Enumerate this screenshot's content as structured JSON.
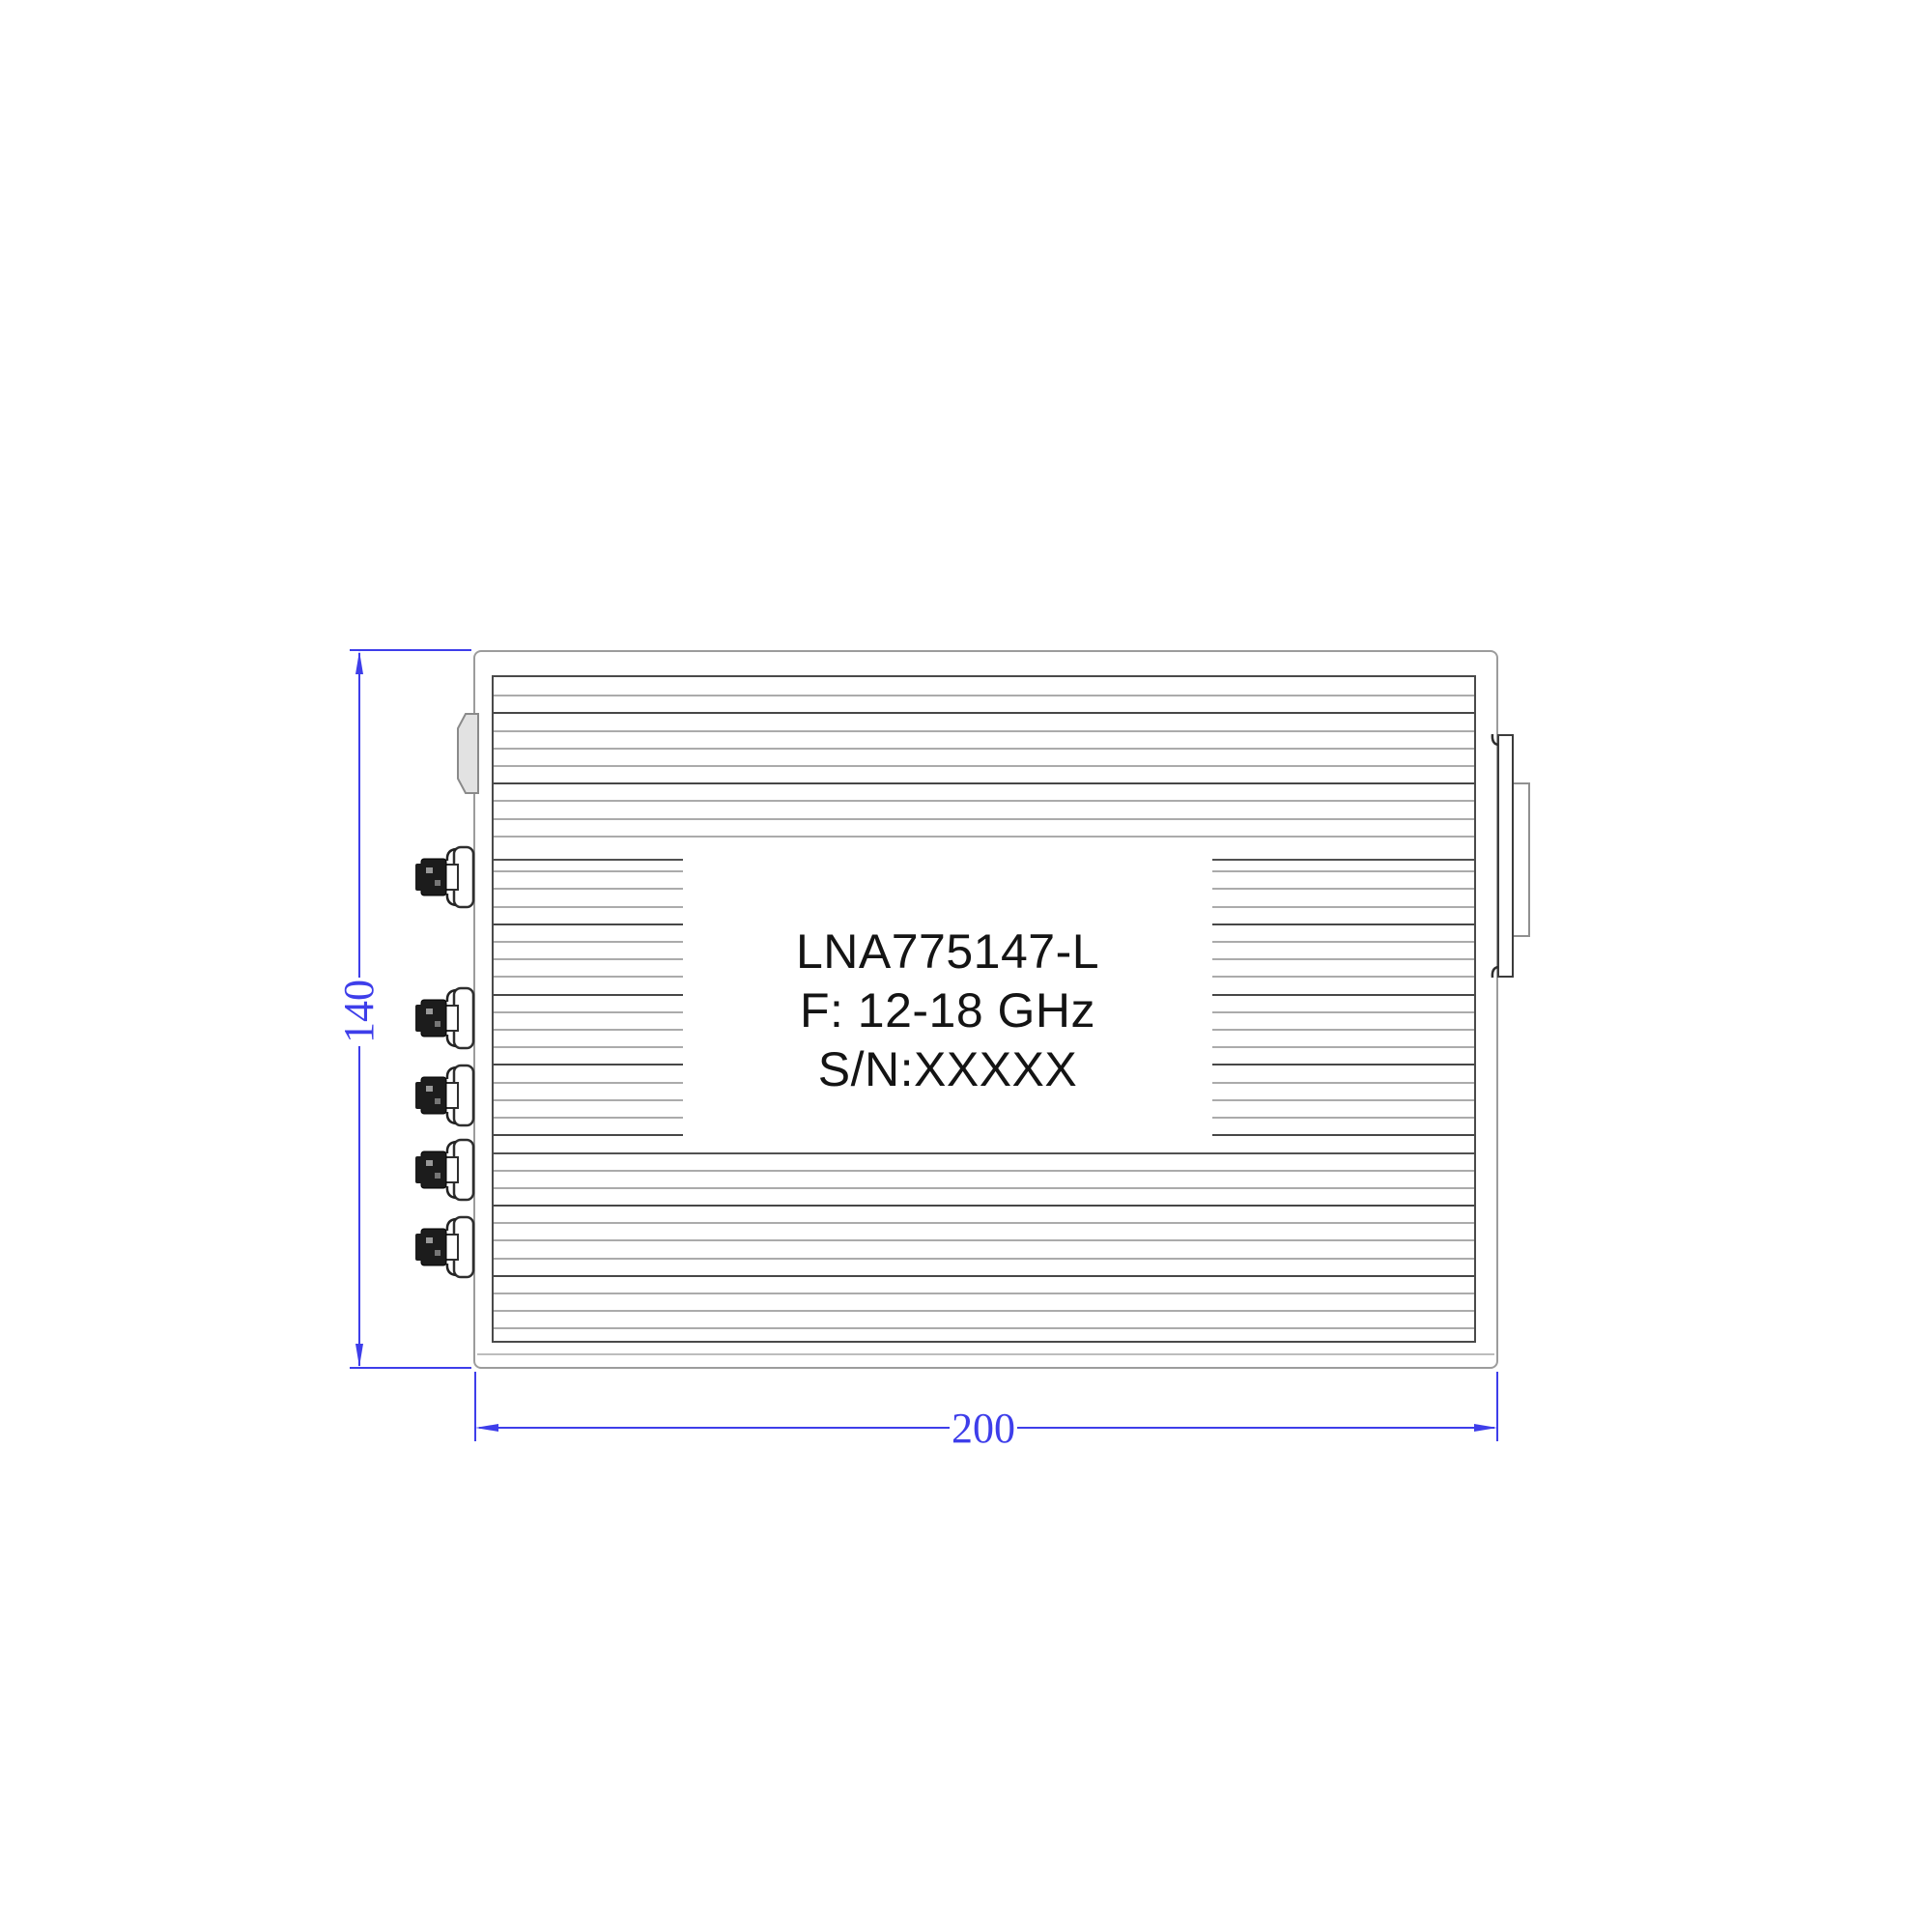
{
  "drawing": {
    "title": "LNA mechanical outline drawing",
    "label": {
      "model": "LNA775147-L",
      "frequency": "F: 12-18 GHz",
      "serial": "S/N:XXXXX"
    },
    "dimensions": {
      "height_mm": "140",
      "width_mm": "200"
    },
    "connectors": {
      "count": 5,
      "side": "left"
    },
    "colors": {
      "dimension_blue": "#3e3eea",
      "body_outline_gray": "#9c9c9c",
      "fin_dark": "#474747",
      "fin_light": "#ababab",
      "label_text": "#141414"
    }
  }
}
